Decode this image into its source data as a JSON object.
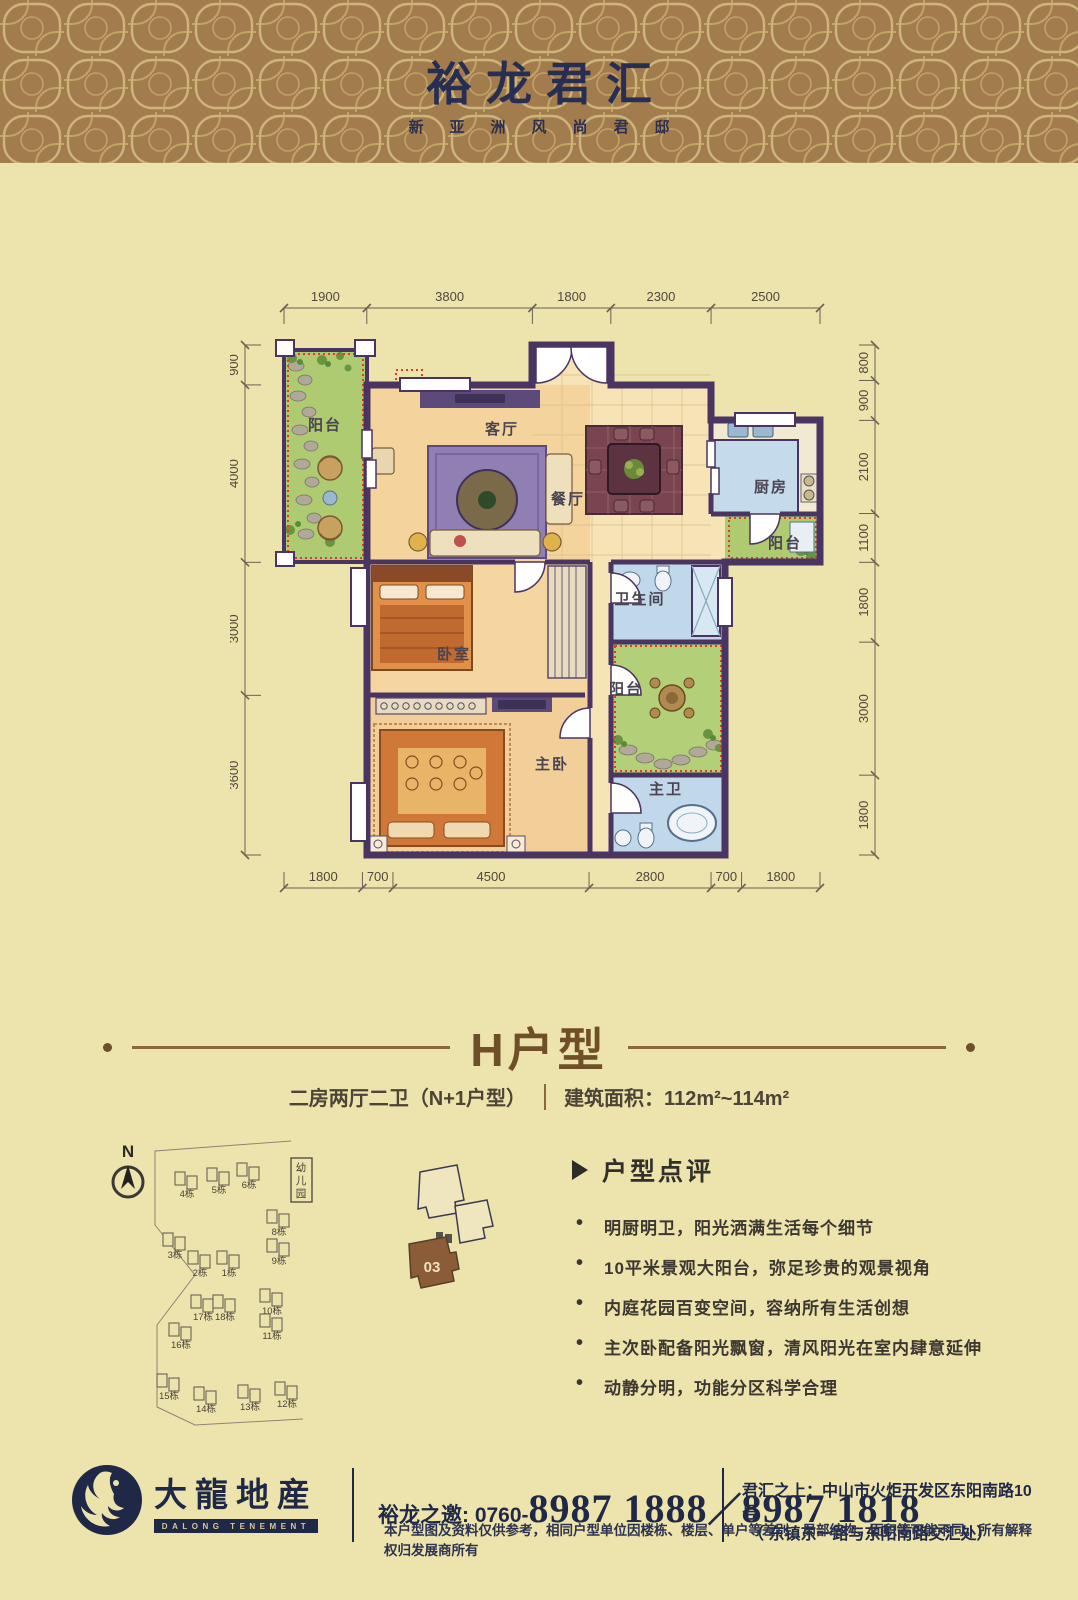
{
  "header": {
    "title": "裕龙君汇",
    "subtitle": "新亚洲风尚君邸",
    "bg": "#a37c4e",
    "pattern_color": "#d5bf80",
    "text_color": "#272e52"
  },
  "plan": {
    "wall_color": "#4a3562",
    "balcony_outline_color": "#e03a28",
    "dims": {
      "top": [
        1900,
        3800,
        1800,
        2300,
        2500
      ],
      "bottom": [
        1800,
        700,
        4500,
        2800,
        700,
        1800
      ],
      "left": [
        900,
        4000,
        3000,
        3600
      ],
      "right": [
        800,
        900,
        2100,
        1100,
        1800,
        3000,
        1800
      ]
    },
    "rooms": [
      {
        "name": "阳台",
        "x": 95,
        "y": 152
      },
      {
        "name": "客厅",
        "x": 272,
        "y": 156
      },
      {
        "name": "餐厅",
        "x": 338,
        "y": 226
      },
      {
        "name": "厨房",
        "x": 541,
        "y": 214
      },
      {
        "name": "阳台",
        "x": 555,
        "y": 270
      },
      {
        "name": "卫生间",
        "x": 410,
        "y": 326
      },
      {
        "name": "卧室",
        "x": 224,
        "y": 381
      },
      {
        "name": "阳台",
        "x": 396,
        "y": 416
      },
      {
        "name": "主卧",
        "x": 322,
        "y": 491
      },
      {
        "name": "主卫",
        "x": 436,
        "y": 516
      }
    ]
  },
  "unit": {
    "title": "H户型",
    "spec": "二房两厅二卫（N+1户型）",
    "area": "建筑面积：112m²~114m²"
  },
  "siteplan": {
    "north": "N",
    "kindergarten": "幼儿园",
    "buildings": [
      {
        "label": "4栋",
        "x": 92,
        "y": 72
      },
      {
        "label": "5栋",
        "x": 124,
        "y": 68
      },
      {
        "label": "6栋",
        "x": 154,
        "y": 63
      },
      {
        "label": "3栋",
        "x": 80,
        "y": 133
      },
      {
        "label": "2栋",
        "x": 105,
        "y": 151
      },
      {
        "label": "1栋",
        "x": 134,
        "y": 151
      },
      {
        "label": "8栋",
        "x": 184,
        "y": 110
      },
      {
        "label": "9栋",
        "x": 184,
        "y": 139
      },
      {
        "label": "17栋",
        "x": 108,
        "y": 195
      },
      {
        "label": "18栋",
        "x": 130,
        "y": 195
      },
      {
        "label": "16栋",
        "x": 86,
        "y": 223
      },
      {
        "label": "10栋",
        "x": 177,
        "y": 189
      },
      {
        "label": "11栋",
        "x": 177,
        "y": 214
      },
      {
        "label": "15栋",
        "x": 74,
        "y": 274
      },
      {
        "label": "14栋",
        "x": 111,
        "y": 287
      },
      {
        "label": "13栋",
        "x": 155,
        "y": 285
      },
      {
        "label": "12栋",
        "x": 192,
        "y": 282
      }
    ]
  },
  "keyplan": {
    "unit_no": "03"
  },
  "review": {
    "heading": "户型点评",
    "bullets": [
      "明厨明卫，阳光洒满生活每个细节",
      "10平米景观大阳台，弥足珍贵的观景视角",
      "内庭花园百变空间，容纳所有生活创想",
      "主次卧配备阳光飘窗，清风阳光在室内肆意延伸",
      "动静分明，功能分区科学合理"
    ]
  },
  "footer": {
    "logo_cn": "大龍地産",
    "logo_en": "DALONG TENEMENT",
    "invite": "裕龙之邀: 0760-",
    "phone1": "8987 1888",
    "sep": "／",
    "phone2": "8987 1818",
    "addr1": "君汇之上：中山市火炬开发区东阳南路10号",
    "addr2": "（ 东镇东一路与东阳南路交汇处）",
    "disclaimer": "本户型图及资料仅供参考，相同户型单位因楼栋、楼层、单户等差别，局部结构、面积等可能不同。所有解释权归发展商所有"
  }
}
